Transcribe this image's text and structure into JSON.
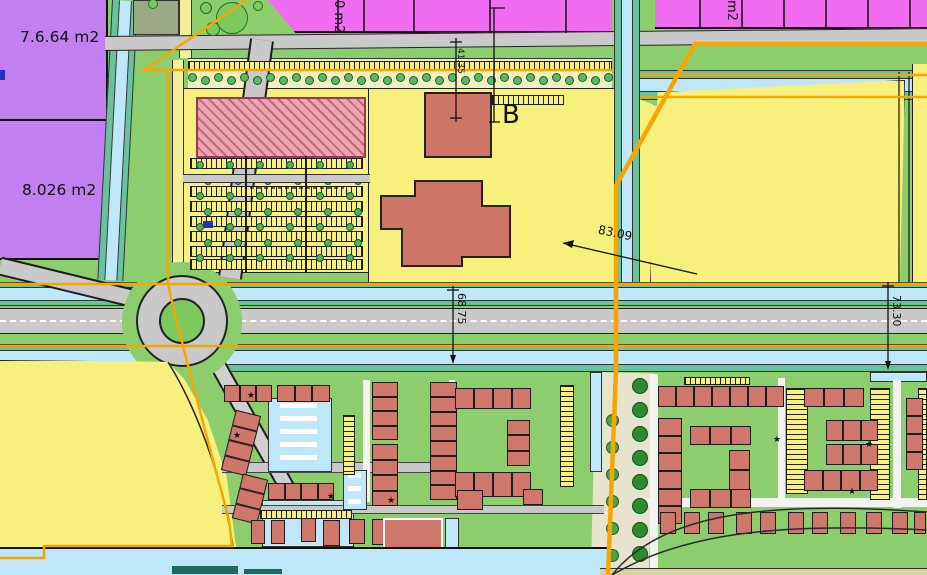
{
  "title": "zoning-plan-map",
  "labels": {
    "area1": "7.6.64 m2",
    "area2": "8.026 m2",
    "building": "B",
    "pink_left": "0 m2",
    "pink_right": "m2",
    "dim_top": "41.35",
    "dim_mid": "68.75",
    "dim_right": "73.30",
    "dim_diag": "83.09"
  },
  "colors": {
    "purple": "#c17ff0",
    "pink": "#f06cf0",
    "yellow": "#f7f07d",
    "paleyellow": "#f3ef9a",
    "salmon": "#d0776b",
    "hatch_bg": "#eba4b2",
    "hatch_line": "#c2697a",
    "water": "#bfe7fa",
    "teal": "#69c29c",
    "road": "#c9c9c9",
    "orange": "#f7a600",
    "green": "#8ccd6e",
    "grass": "#7cc95e",
    "dark_teal": "#1a6b60",
    "tan": "#e8e3cc",
    "tree_dark": "#2e8b34",
    "line": "#1d1d1d"
  },
  "map": {
    "houses": [
      [
        224,
        385,
        48,
        17,
        "h",
        3,
        0
      ],
      [
        277,
        385,
        53,
        17,
        "h",
        3,
        0
      ],
      [
        228,
        412,
        26,
        62,
        "v",
        4,
        14
      ],
      [
        237,
        476,
        26,
        46,
        "v",
        3,
        14
      ],
      [
        268,
        483,
        66,
        17,
        "h",
        4,
        0
      ],
      [
        372,
        382,
        26,
        58,
        "v",
        4,
        0
      ],
      [
        372,
        444,
        26,
        62,
        "v",
        4,
        0
      ],
      [
        430,
        382,
        27,
        118,
        "v",
        8,
        0
      ],
      [
        455,
        388,
        76,
        21,
        "h",
        4,
        0
      ],
      [
        507,
        420,
        23,
        46,
        "v",
        3,
        0
      ],
      [
        455,
        472,
        76,
        25,
        "h",
        4,
        0
      ],
      [
        658,
        386,
        126,
        21,
        "h",
        7,
        0
      ],
      [
        658,
        418,
        24,
        106,
        "v",
        6,
        0
      ],
      [
        690,
        426,
        61,
        19,
        "h",
        3,
        0
      ],
      [
        729,
        450,
        21,
        40,
        "v",
        2,
        0
      ],
      [
        690,
        489,
        61,
        19,
        "h",
        3,
        0
      ],
      [
        804,
        388,
        60,
        19,
        "h",
        3,
        0
      ],
      [
        826,
        420,
        52,
        21,
        "h",
        3,
        0
      ],
      [
        826,
        444,
        52,
        21,
        "h",
        3,
        0
      ],
      [
        804,
        470,
        74,
        21,
        "h",
        4,
        0
      ],
      [
        906,
        398,
        17,
        72,
        "v",
        4,
        0
      ]
    ],
    "detached": [
      [
        251,
        520,
        14,
        24
      ],
      [
        271,
        520,
        14,
        24
      ],
      [
        301,
        518,
        15,
        24
      ],
      [
        323,
        520,
        17,
        26
      ],
      [
        349,
        519,
        16,
        25
      ],
      [
        372,
        519,
        15,
        26
      ],
      [
        457,
        490,
        26,
        20
      ],
      [
        523,
        489,
        20,
        16
      ],
      [
        660,
        512,
        16,
        22
      ],
      [
        684,
        512,
        16,
        22
      ],
      [
        708,
        512,
        16,
        22
      ],
      [
        736,
        512,
        16,
        22
      ],
      [
        760,
        512,
        16,
        22
      ],
      [
        788,
        512,
        16,
        22
      ],
      [
        812,
        512,
        16,
        22
      ],
      [
        840,
        512,
        16,
        22
      ],
      [
        866,
        512,
        16,
        22
      ],
      [
        892,
        512,
        16,
        22
      ],
      [
        914,
        512,
        12,
        22
      ]
    ],
    "big_building": [
      383,
      518,
      60,
      32
    ],
    "ladders": [
      [
        492,
        95,
        72,
        10,
        "h"
      ],
      [
        188,
        61,
        424,
        10,
        "h"
      ],
      [
        560,
        385,
        14,
        102,
        "v"
      ],
      [
        786,
        388,
        22,
        106,
        "v"
      ],
      [
        870,
        388,
        20,
        112,
        "v"
      ],
      [
        918,
        388,
        9,
        112,
        "v"
      ],
      [
        684,
        377,
        66,
        8,
        "h"
      ],
      [
        260,
        510,
        92,
        9,
        "h"
      ],
      [
        343,
        415,
        12,
        60,
        "v"
      ],
      [
        190,
        158,
        173,
        11,
        "h"
      ],
      [
        190,
        186,
        173,
        11,
        "h"
      ],
      [
        190,
        201,
        173,
        11,
        "h"
      ],
      [
        190,
        216,
        173,
        11,
        "h"
      ],
      [
        190,
        231,
        173,
        11,
        "h"
      ],
      [
        190,
        246,
        173,
        11,
        "h"
      ],
      [
        190,
        259,
        173,
        11,
        "h"
      ]
    ],
    "courts": [
      [
        268,
        398,
        64,
        74
      ],
      [
        343,
        470,
        24,
        40
      ]
    ],
    "waters": [
      [
        262,
        500,
        92,
        47
      ],
      [
        445,
        518,
        14,
        32
      ],
      [
        870,
        372,
        57,
        10
      ],
      [
        590,
        372,
        12,
        100
      ]
    ],
    "white_paths": [
      [
        363,
        380,
        7,
        122
      ],
      [
        449,
        380,
        6,
        120
      ],
      [
        778,
        378,
        7,
        122
      ],
      [
        893,
        380,
        8,
        128
      ],
      [
        640,
        498,
        287,
        9
      ],
      [
        650,
        374,
        8,
        200
      ]
    ],
    "gray_streets": [
      [
        222,
        462,
        211,
        11
      ],
      [
        222,
        505,
        382,
        9
      ]
    ],
    "stars": [
      [
        247,
        392
      ],
      [
        233,
        432
      ],
      [
        327,
        493
      ],
      [
        387,
        497
      ],
      [
        773,
        436
      ],
      [
        865,
        441
      ],
      [
        848,
        488
      ]
    ],
    "tree_groups": [
      {
        "x": 192,
        "y": 77,
        "dx": 13,
        "dy": 0,
        "cols": 33,
        "rows": 1,
        "r": 4.5,
        "f": "#5cb868",
        "s": "#1d5c2a",
        "jy": 3
      },
      {
        "x": 200,
        "y": 165,
        "dx": 30,
        "dy": 15.5,
        "cols": 6,
        "rows": 7,
        "r": 4,
        "f": "#55b060",
        "s": "#1d5c2a",
        "jx": 8
      },
      {
        "x": 640,
        "y": 386,
        "dx": 0,
        "dy": 24,
        "cols": 1,
        "rows": 8,
        "r": 8,
        "f": "#2e8b34",
        "s": "#0f4f16"
      },
      {
        "x": 612,
        "y": 420,
        "dx": 0,
        "dy": 27,
        "cols": 1,
        "rows": 6,
        "r": 6.5,
        "f": "#4aa546",
        "s": "#1d5c2a"
      }
    ],
    "single_trees": [
      [
        153,
        4,
        5
      ],
      [
        206,
        8,
        6
      ],
      [
        213,
        29,
        7
      ],
      [
        258,
        6,
        5
      ],
      [
        232,
        18,
        16
      ]
    ],
    "pink_dividers_left": [
      338,
      364,
      414,
      490,
      566
    ],
    "pink_dividers_right": [
      700,
      742,
      784,
      826,
      868,
      910
    ]
  }
}
